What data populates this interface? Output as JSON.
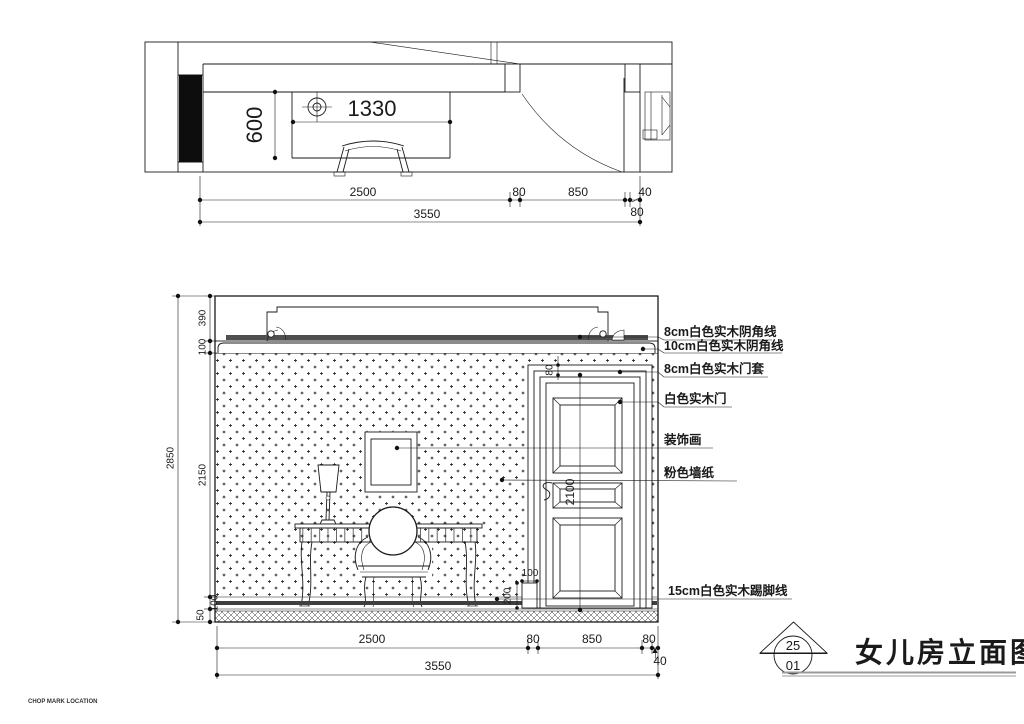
{
  "plan": {
    "fixture_width": "1330",
    "fixture_depth": "600",
    "dims_row1": [
      "2500",
      "80",
      "850",
      "40"
    ],
    "dim_row2": "80",
    "dim_total": "3550"
  },
  "elevation": {
    "left_dims": [
      "390",
      "100",
      "2150",
      "100",
      "50"
    ],
    "left_total": "2850",
    "bottom_dims": [
      "2500",
      "80",
      "850",
      "80"
    ],
    "bottom_dim_small": "40",
    "bottom_total": "3550",
    "door_height": "2100",
    "door_casing": "80",
    "plinth_width": "100",
    "plinth_height": "200",
    "labels": [
      "8cm白色实木阴角线",
      "10cm白色实木阴角线",
      "8cm白色实木门套",
      "白色实木门",
      "装饰画",
      "粉色墙纸",
      "15cm白色实木踢脚线"
    ]
  },
  "title_block": {
    "index_top": "25",
    "index_bottom": "01",
    "title": "女儿房立面图"
  },
  "footer": {
    "stamp": "CHOP MARK LOCATION"
  }
}
